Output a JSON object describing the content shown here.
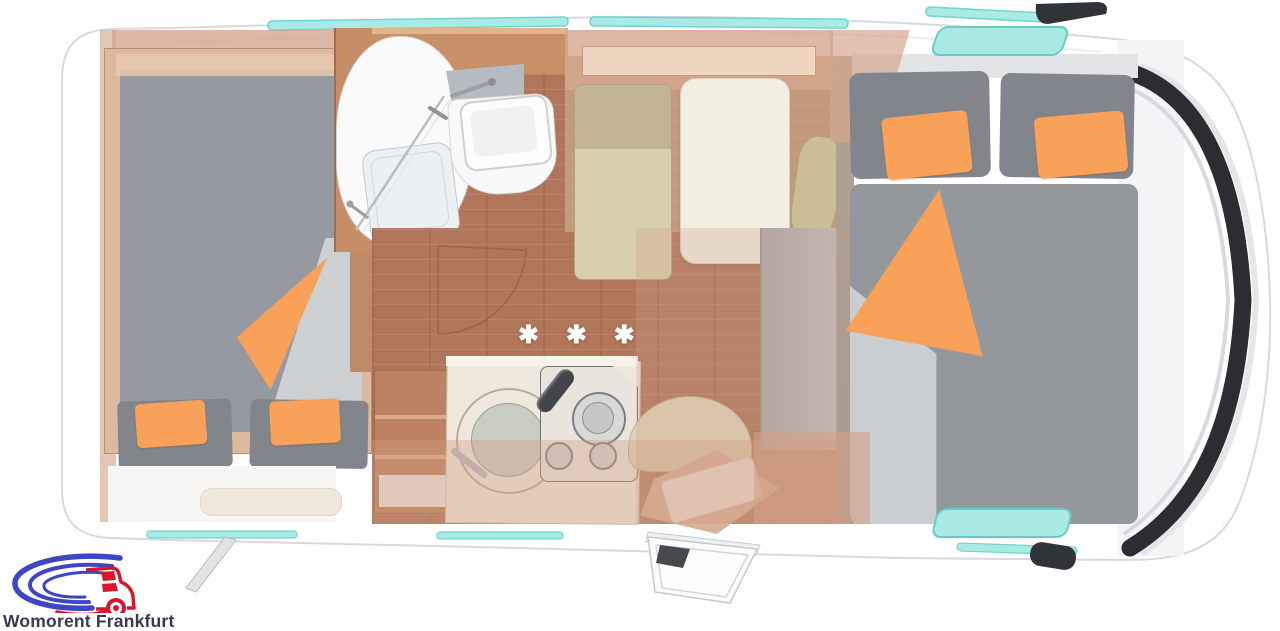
{
  "brand": {
    "name": "Womorent Frankfurt"
  },
  "floorplan": {
    "floor_marking": "✱ ✱ ✱",
    "features": [
      "rear-double-bed",
      "overhead-cabinets",
      "wardrobe",
      "bathroom-shower",
      "bathroom-washbasin",
      "bathroom-mirror",
      "kitchen-shelf",
      "kitchen-sink",
      "gas-stove-3-burner",
      "dinette-bench",
      "dinette-table",
      "side-seats",
      "entry-door-open",
      "entry-step",
      "front-double-bed",
      "roof-skylights",
      "side-windows",
      "cab-windshield",
      "side-mirrors",
      "awning-support"
    ],
    "colors": {
      "body": "#ffffff",
      "accent_orange": "#f9a159",
      "mattress_gray": "#94989d",
      "pillow_gray": "#82868c",
      "wood_floor": "#b1755a",
      "furniture_wood": "#c58e69",
      "wall_overlay": "#d5a48c",
      "window_cyan": "#a9eae4",
      "bench_beige": "#d9cfae",
      "table_cream": "#f2eee1",
      "windshield_black": "#2b2d30",
      "logo_blue": "#3f46c4",
      "logo_red": "#d8172f",
      "logo_text": "#363c4e"
    }
  }
}
